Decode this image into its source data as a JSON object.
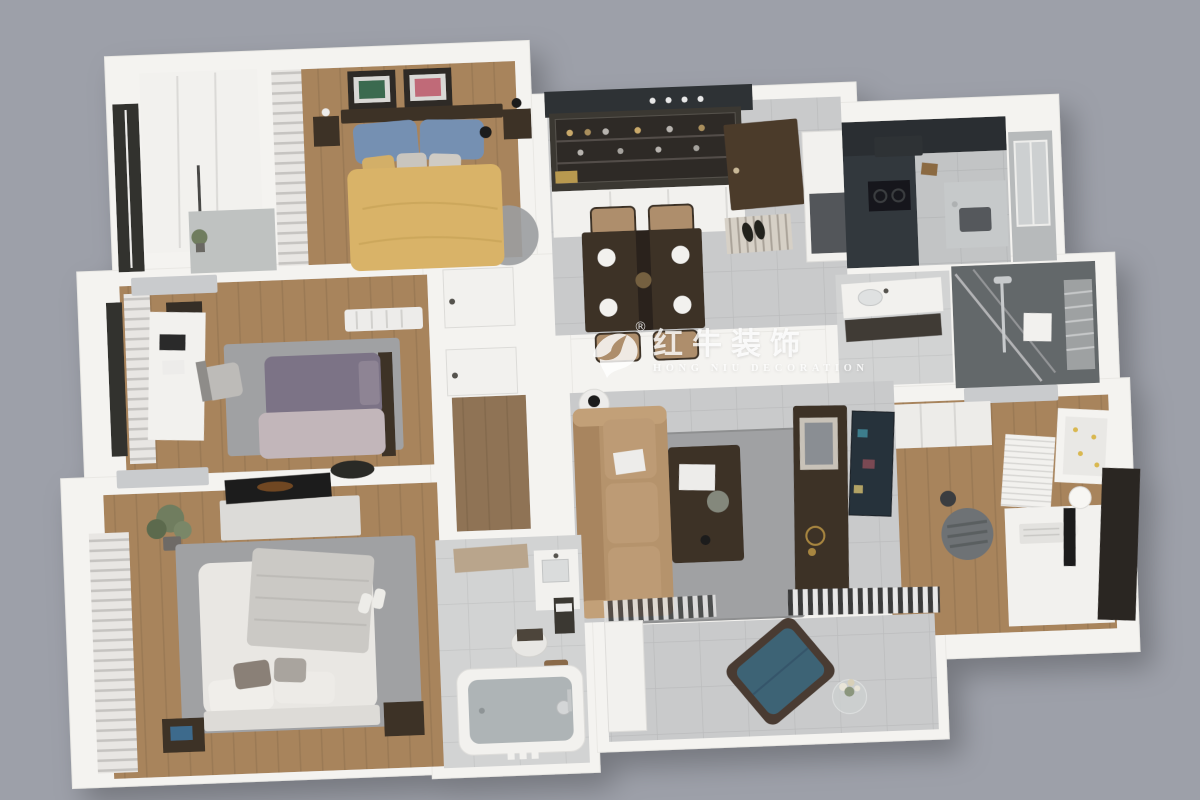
{
  "watermark": {
    "logo_cn": "红牛装饰",
    "logo_en": "HONG NIU DECORATION",
    "trademark": "®",
    "icon": "bull-swoosh-logo"
  },
  "scene": {
    "type": "3d-floorplan-cutaway-render",
    "description": "Top-down isometric cutaway render of a furnished three-bedroom apartment with white walls on a plain gray backdrop",
    "rooms": [
      {
        "label": "balcony closet with black framed window, white wardrobe and small plant"
      },
      {
        "label": "bedroom with yellow duvet bed, blue pillows, two framed artworks, dark headboard and nightstands, striped curtain"
      },
      {
        "label": "bedroom study with purple duvet bed, blush blanket, gray rug, white desk, chair, radiator and wall air conditioner"
      },
      {
        "label": "master bedroom with white bed, gray knit throw, gray rug, TV console with flat TV, potted plant, striped curtains, dark nightstands, slippers"
      },
      {
        "label": "hallway with wood floor and two white interior doors"
      },
      {
        "label": "dining room with dark wood table, four tan chairs, white place settings, glass display cabinet with bottles, dark ceiling band with downlights"
      },
      {
        "label": "entryway with dark brown front door, striped shoe mat, black shoes and tall white cabinet with gray appliance"
      },
      {
        "label": "kitchen with dark gray cabinets, range hood, black cooktop, sink counter and tiled window wall"
      },
      {
        "label": "bathroom with white vanity, basin, dark cabinet, dark tiled walk-in shower with glass panel and slatted window"
      },
      {
        "label": "study with wood floor, white desk, keyboard, monitor, lamp, book stacks, dotted pin board, gray office chair and dark wardrobe"
      },
      {
        "label": "living room with tan leather sofa, white book, dark coffee table, gray rug, dark TV cabinet, leaning art panel, gold decor and striped textiles"
      },
      {
        "label": "bathroom with bathtub, chrome faucet, white sink unit, dark shelf, toilet and wooden stool"
      },
      {
        "label": "balcony lounge with teal armchair, wood frame, glass side table with white flowers"
      }
    ]
  },
  "palette": {
    "background": "#9DA0A9",
    "building": "#F4F3F0",
    "wood": "#A8845C",
    "wood_dark": "#8F7355",
    "tile": "#C9CACB",
    "tile_bath": "#D2D3D3",
    "rug": "#A0A1A3",
    "dark_furniture": "#3C3228",
    "charcoal": "#2F3236",
    "yellow_bed": "#D9B367",
    "blue_pillow": "#7590B2",
    "purple_bed": "#7C7386",
    "blush": "#C2B6BA",
    "white_bed": "#E9E7E3",
    "sofa_tan": "#B5936C",
    "chair_tan": "#AE8E6C",
    "teal_chair": "#3E6375",
    "shower_tile": "#64676A",
    "kitchen_cabinet": "#33383C",
    "door_brown": "#4C3B2C",
    "ac_gray": "#C9CBCD",
    "plant_green": "#6F7D5E",
    "tv_black": "#1F1D1B",
    "art_green": "#3A6B4F",
    "art_pink": "#C06A78",
    "watermark": "rgba(255,255,255,0.85)"
  }
}
